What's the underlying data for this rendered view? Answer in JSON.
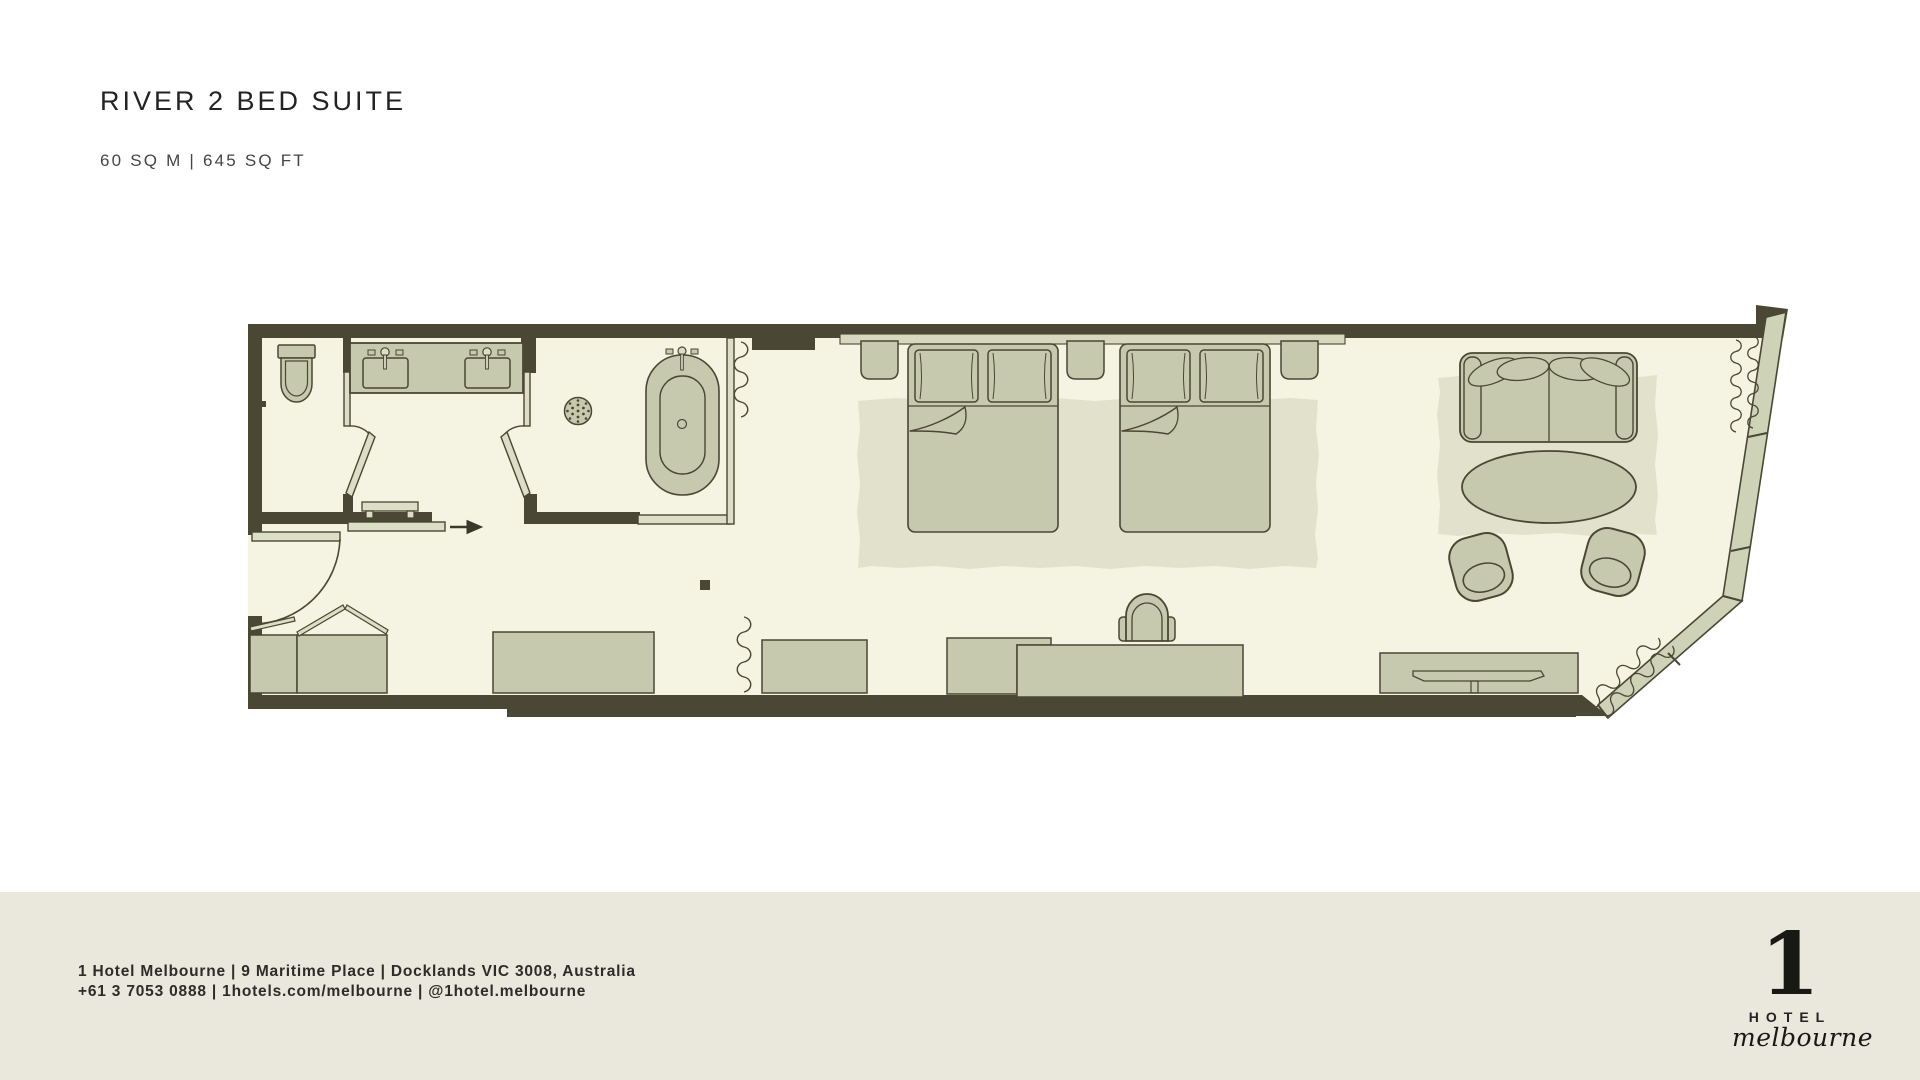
{
  "page": {
    "title": "RIVER 2 BED SUITE",
    "area": "60 SQ M | 645 SQ FT"
  },
  "footer": {
    "line1": "1 Hotel Melbourne | 9 Maritime Place | Docklands VIC 3008, Australia",
    "line2": "+61 3 7053 0888 | 1hotels.com/melbourne | @1hotel.melbourne"
  },
  "logo": {
    "numeral": "1",
    "hotel": "HOTEL",
    "city": "melbourne"
  },
  "colors": {
    "wall": "#4a4734",
    "floor": "#f5f3e1",
    "fixture": "#c6c9ad",
    "rug": "#e2e2cc",
    "glass_window": "#ced2b7",
    "door_panel": "#dcdec6",
    "headboard": "#d7d8bd",
    "footer_band": "#eae7dc",
    "text_dark": "#232323"
  },
  "floorplan": {
    "fixtures": [
      "toilet",
      "double-vanity",
      "walk-in-shower",
      "bathtub",
      "entry-door",
      "wardrobe",
      "luggage-rack",
      "bed-1",
      "bed-2",
      "nightstands",
      "desk",
      "desk-chair",
      "credenza",
      "minibar-unit",
      "tv-console",
      "tv",
      "sofa",
      "oval-table",
      "armchairs",
      "rugs",
      "curtains",
      "angled-window-wall"
    ]
  }
}
